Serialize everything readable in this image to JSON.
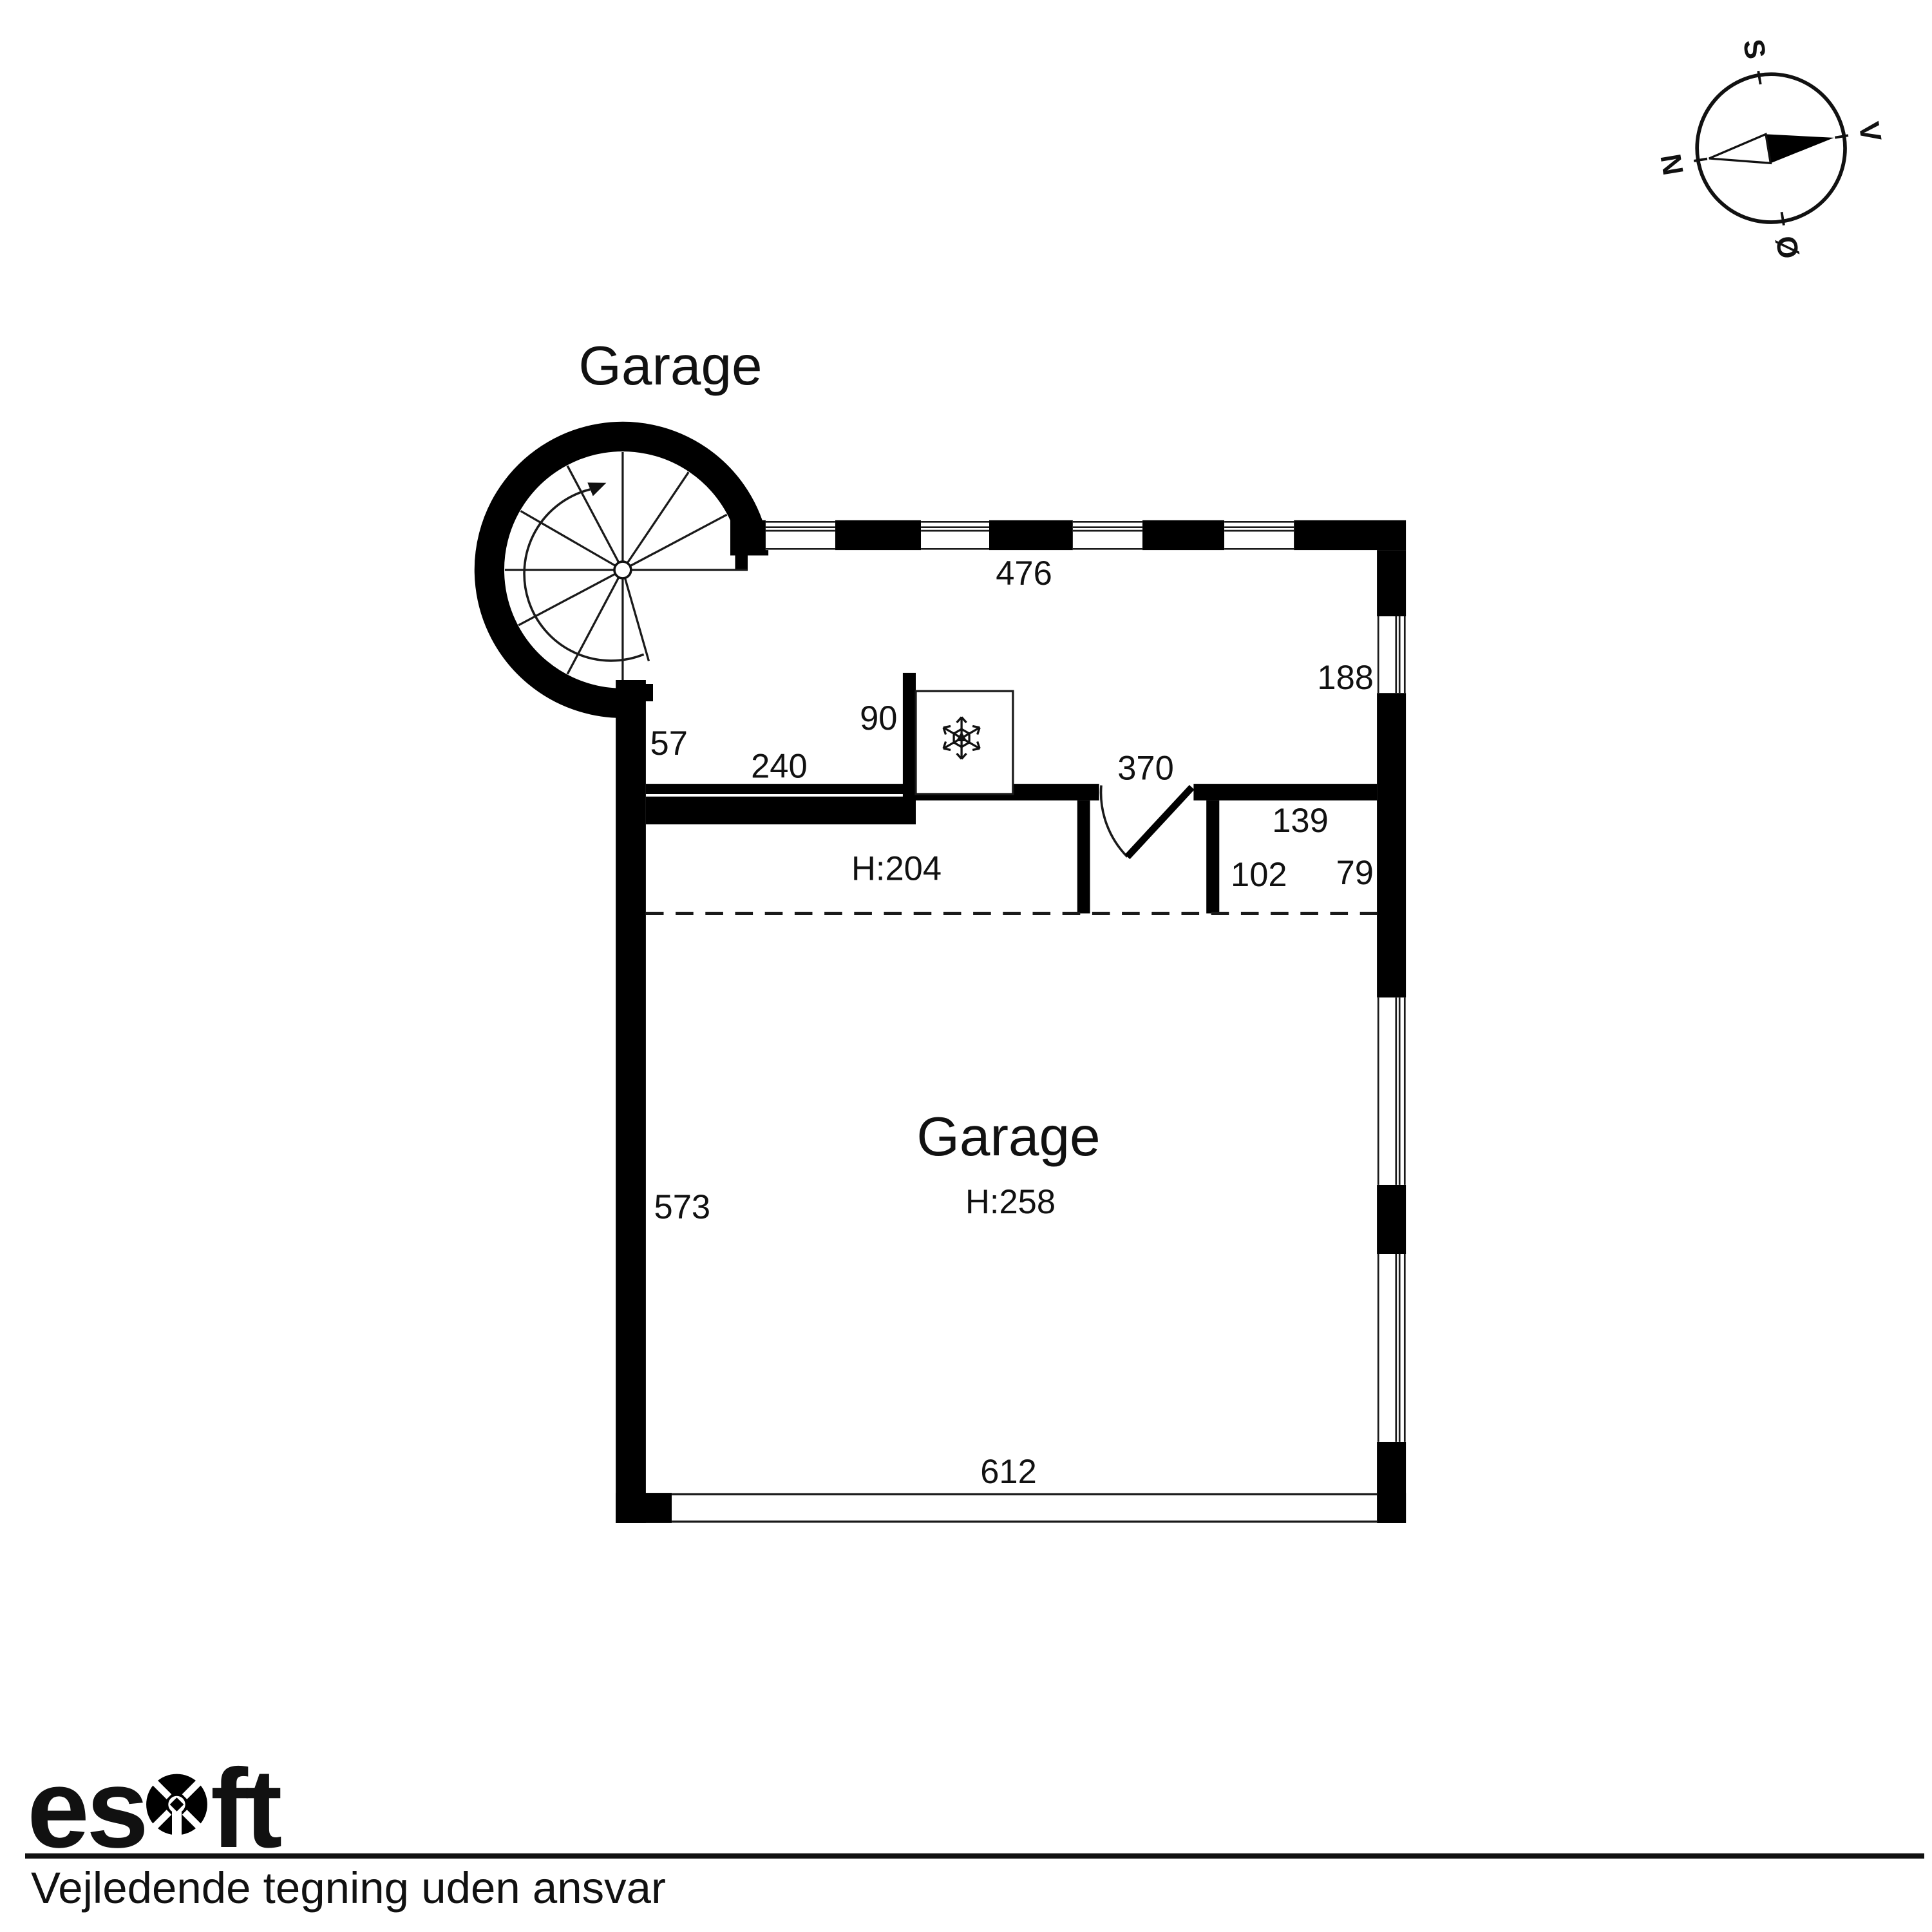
{
  "plan": {
    "building_label": "Garage",
    "rooms": {
      "garage_main": {
        "name": "Garage",
        "height": "H:258"
      },
      "upper_room": {
        "height": "H:204"
      }
    },
    "dimensions": {
      "top_wall": "476",
      "right_window": "188",
      "stair_wall": "57",
      "upper_room_width": "240",
      "freezer_width": "90",
      "upper_room_right": "370",
      "right_room_width": "139",
      "right_room_depth": "102",
      "right_room_side": "79",
      "left_wall": "573",
      "bottom_wall": "612"
    }
  },
  "compass": {
    "letters": {
      "north": "N",
      "south": "S",
      "east": "Ø",
      "west": "V"
    }
  },
  "icons": {
    "compass": "compass-rose",
    "stairs": "spiral-staircase",
    "freezer": "snowflake"
  },
  "footer": {
    "logo_text": "esoft",
    "logo_part1": "es",
    "logo_part2": "ft",
    "disclaimer": "Vejledende tegning uden ansvar"
  },
  "colors": {
    "wall": "#000000",
    "line": "#1a1a1a",
    "background": "#ffffff",
    "text": "#111111"
  }
}
